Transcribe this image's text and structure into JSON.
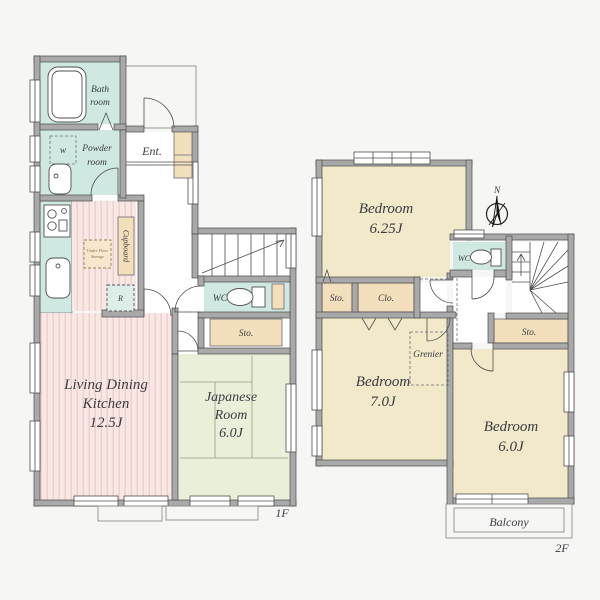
{
  "floor1": {
    "label": "1F",
    "bath_room": {
      "line1": "Bath",
      "line2": "room"
    },
    "powder_room": {
      "line1": "Powder",
      "line2": "room"
    },
    "washer": "w",
    "entrance": "Ent.",
    "cupboard": "Cupboard",
    "refrigerator": "R",
    "under_floor_storage": {
      "line1": "Under Floor",
      "line2": "Storage"
    },
    "ldk": {
      "line1": "Living Dining",
      "line2": "Kitchen",
      "line3": "12.5J"
    },
    "wc": "WC",
    "storage": "Sto.",
    "japanese_room": {
      "line1": "Japanese",
      "line2": "Room",
      "line3": "6.0J"
    }
  },
  "floor2": {
    "label": "2F",
    "compass_north": "N",
    "bedroom_625": {
      "line1": "Bedroom",
      "line2": "6.25J"
    },
    "bedroom_70": {
      "line1": "Bedroom",
      "line2": "7.0J"
    },
    "bedroom_60": {
      "line1": "Bedroom",
      "line2": "6.0J"
    },
    "wc": "WC",
    "storage_left": "Sto.",
    "closet": "Clo.",
    "storage_right": "Sto.",
    "grenier": "Grenier",
    "balcony": "Balcony"
  },
  "colors": {
    "bg": "#f6f6f4",
    "wall": "#a9a9a9",
    "wall-edge": "#4a4a4a",
    "water": "#cfe8e2",
    "wood": "#f9e7e4",
    "wood-stripe": "#ebcdc9",
    "tatami": "#e9f0da",
    "tatami-line": "#93a180",
    "bedroom": "#f1e9ca",
    "storage": "#f3dfbc",
    "ink": "#3b3b42"
  }
}
